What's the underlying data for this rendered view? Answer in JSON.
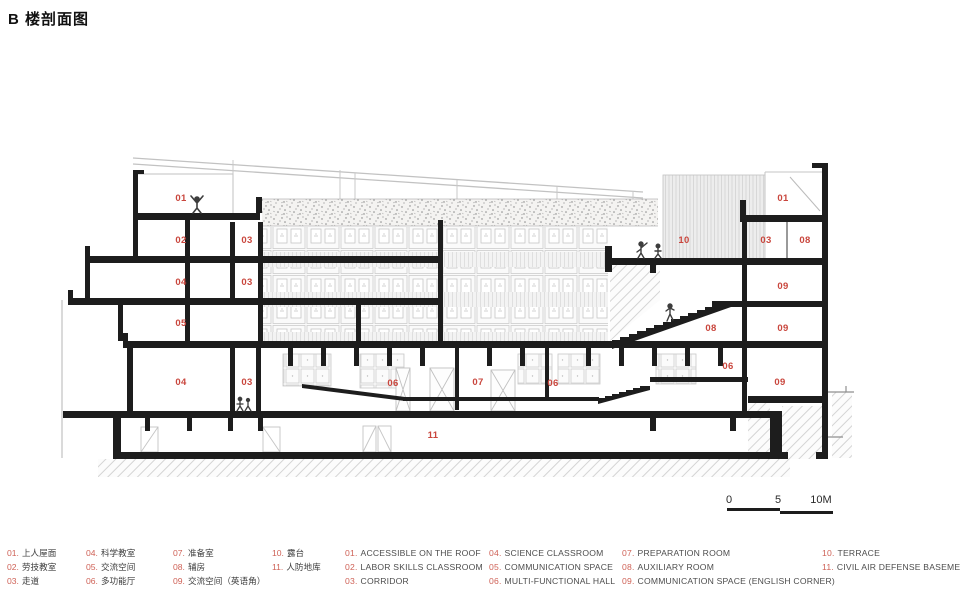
{
  "title": "B 楼剖面图",
  "drawing": {
    "labels": [
      "01",
      "02",
      "03",
      "04",
      "03",
      "05",
      "04",
      "03",
      "06",
      "07",
      "06",
      "11",
      "10",
      "03",
      "08",
      "01",
      "09",
      "08",
      "09",
      "06",
      "09"
    ],
    "scale": {
      "t0": "0",
      "t5": "5",
      "t10": "10M"
    }
  },
  "legend": {
    "cn": [
      {
        "num": "01.",
        "label": "上人屋面"
      },
      {
        "num": "02.",
        "label": "劳技教室"
      },
      {
        "num": "03.",
        "label": "走道"
      },
      {
        "num": "04.",
        "label": "科学教室"
      },
      {
        "num": "05.",
        "label": "交流空间"
      },
      {
        "num": "06.",
        "label": "多功能厅"
      },
      {
        "num": "07.",
        "label": "准备室"
      },
      {
        "num": "08.",
        "label": "辅房"
      },
      {
        "num": "09.",
        "label": "交流空间（英语角）"
      },
      {
        "num": "10.",
        "label": "露台"
      },
      {
        "num": "11.",
        "label": "人防地库"
      }
    ],
    "en": [
      {
        "num": "01.",
        "label": "ACCESSIBLE ON THE ROOF"
      },
      {
        "num": "02.",
        "label": "LABOR SKILLS CLASSROOM"
      },
      {
        "num": "03.",
        "label": "CORRIDOR"
      },
      {
        "num": "04.",
        "label": "SCIENCE CLASSROOM"
      },
      {
        "num": "05.",
        "label": "COMMUNICATION SPACE"
      },
      {
        "num": "06.",
        "label": "MULTI-FUNCTIONAL HALL"
      },
      {
        "num": "07.",
        "label": "PREPARATION ROOM"
      },
      {
        "num": "08.",
        "label": "AUXILIARY ROOM"
      },
      {
        "num": "09.",
        "label": "COMMUNICATION SPACE (ENGLISH CORNER)"
      },
      {
        "num": "10.",
        "label": "TERRACE"
      },
      {
        "num": "11.",
        "label": "CIVIL AIR DEFENSE BASEMENTS"
      }
    ]
  },
  "colors": {
    "accent": "#c9463d",
    "ink": "#1d1d1d"
  }
}
